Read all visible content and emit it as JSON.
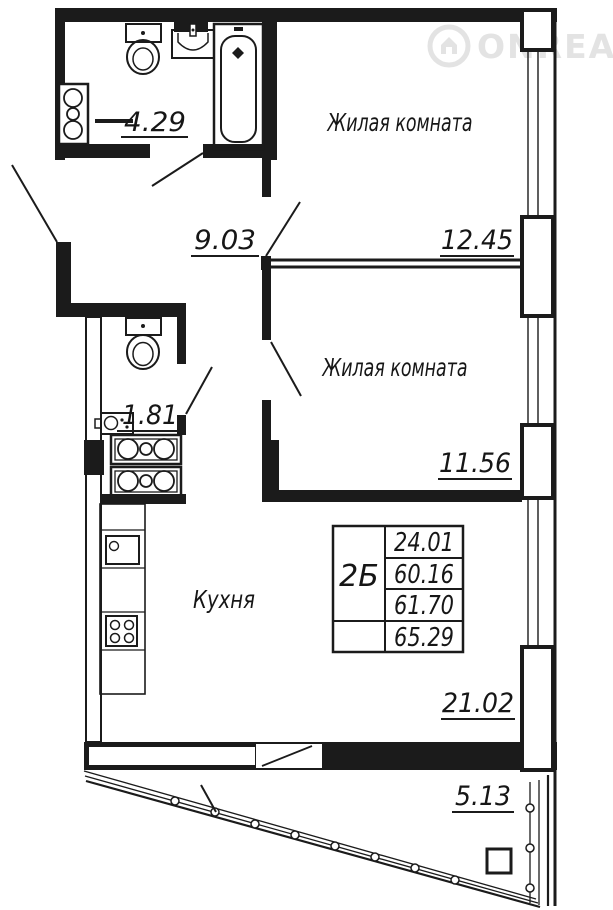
{
  "watermark": {
    "brand": "ONREALT",
    "icon": "house-in-circle-icon"
  },
  "rooms": {
    "living1": {
      "label": "Жилая комната",
      "area": "12.45"
    },
    "living2": {
      "label": "Жилая комната",
      "area": "11.56"
    },
    "kitchen": {
      "label": "Кухня",
      "area": "21.02"
    },
    "hallway": {
      "area": "9.03"
    },
    "bathroom": {
      "area": "4.29"
    },
    "wc": {
      "area": "1.81"
    },
    "balcony": {
      "area": "5.13"
    }
  },
  "spec_table": {
    "unit_type": "2Б",
    "rows": [
      "24.01",
      "60.16",
      "61.70",
      "65.29"
    ]
  },
  "colors": {
    "line": "#1b1b1b",
    "background": "#ffffff",
    "watermark": "#e3e3e3"
  }
}
